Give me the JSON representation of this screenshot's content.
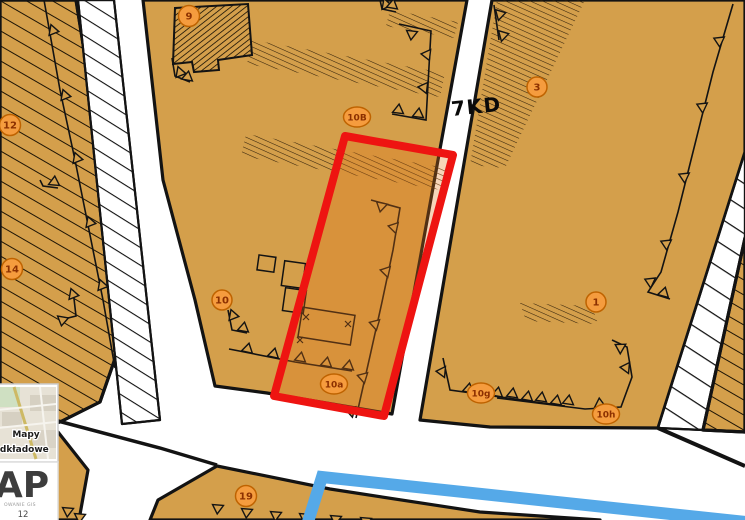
{
  "map": {
    "type": "zoning-plan",
    "road_label": "7KD",
    "parcel_labels": [
      "9",
      "12",
      "14",
      "10B",
      "3",
      "10",
      "1",
      "10a",
      "10g",
      "10h",
      "19"
    ],
    "selection": {
      "primary_color": "#ee1411",
      "secondary_color": "#55a9e8"
    },
    "colors": {
      "parcel": "#d49f4b",
      "parcel_inside_selection": "#cf8a3e",
      "road": "#ffffff",
      "boundary": "#131313",
      "label_circle_fill": "#f59c3e",
      "label_circle_border": "#bf6300",
      "label_text": "#8c3000"
    }
  },
  "overlay": {
    "basemap_panel": {
      "title_line1": "Mapy",
      "title_line2": "podkładowe"
    },
    "logo_panel": {
      "logo_text": "AP",
      "subtext": "OWANIE GIS",
      "number": "12"
    }
  }
}
